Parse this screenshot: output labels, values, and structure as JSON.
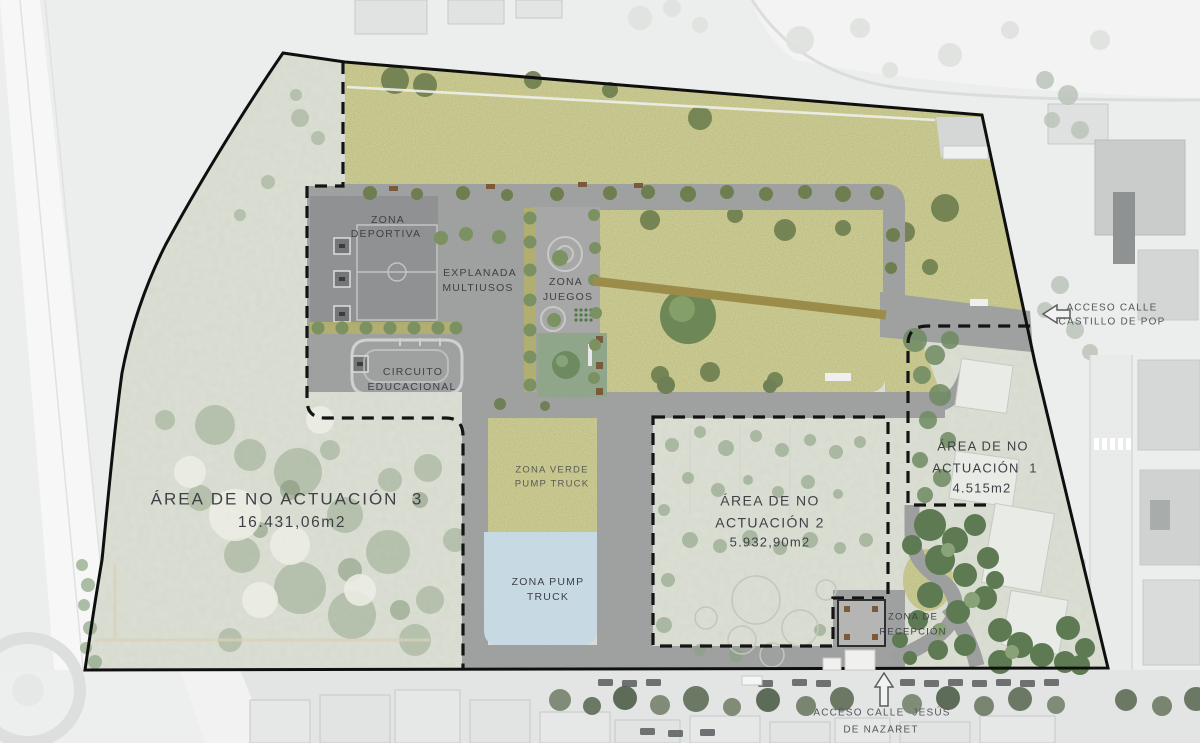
{
  "zones": {
    "deportiva": {
      "line1": "ZONA",
      "line2": "DEPORTIVA"
    },
    "explanada": {
      "line1": "EXPLANADA",
      "line2": "MULTIUSOS"
    },
    "juegos": {
      "line1": "ZONA",
      "line2": "JUEGOS"
    },
    "circuito": {
      "line1": "CIRCUITO",
      "line2": "EDUCACIONAL"
    },
    "zona_verde_pump_truck": {
      "line1": "ZONA VERDE",
      "line2": "PUMP TRUCK"
    },
    "zona_pump_truck": {
      "line1": "ZONA PUMP",
      "line2": "TRUCK"
    },
    "recepcion": {
      "line1": "ZONA DE",
      "line2": "RECEPCIÓN"
    }
  },
  "areas": {
    "area3": {
      "name": "ÁREA DE NO ACTUACIÓN  3",
      "surface": "16.431,06m2"
    },
    "area2": {
      "line1": "ÁREA DE NO",
      "line2": "ACTUACIÓN 2",
      "surface": "5.932,90m2"
    },
    "area1": {
      "line1": "ÁREA DE NO",
      "line2": "ACTUACIÓN  1",
      "surface": "4.515m2"
    }
  },
  "accesses": {
    "castillo": {
      "line1": "ACCESO CALLE",
      "line2": "CASTILLO DE POP"
    },
    "nazaret": {
      "line1": "ACCESO CALLE  JESÚS",
      "line2": "DE NAZARET"
    }
  },
  "colors": {
    "vegetation": "#b9b873",
    "plaza": "#9d9e9e",
    "deportiva_court": "#8f9193",
    "juegos": "#a6a7a6",
    "green_zone": "#8fa68a",
    "pump_blue": "#c7d9e3",
    "dense_green": "#5d7a52",
    "dirt_path": "#9c8c49",
    "pale_ground": "#dcdfd5",
    "outside": "#eceeed",
    "label": "#3e4246",
    "boundary": "#0f0f0f"
  }
}
